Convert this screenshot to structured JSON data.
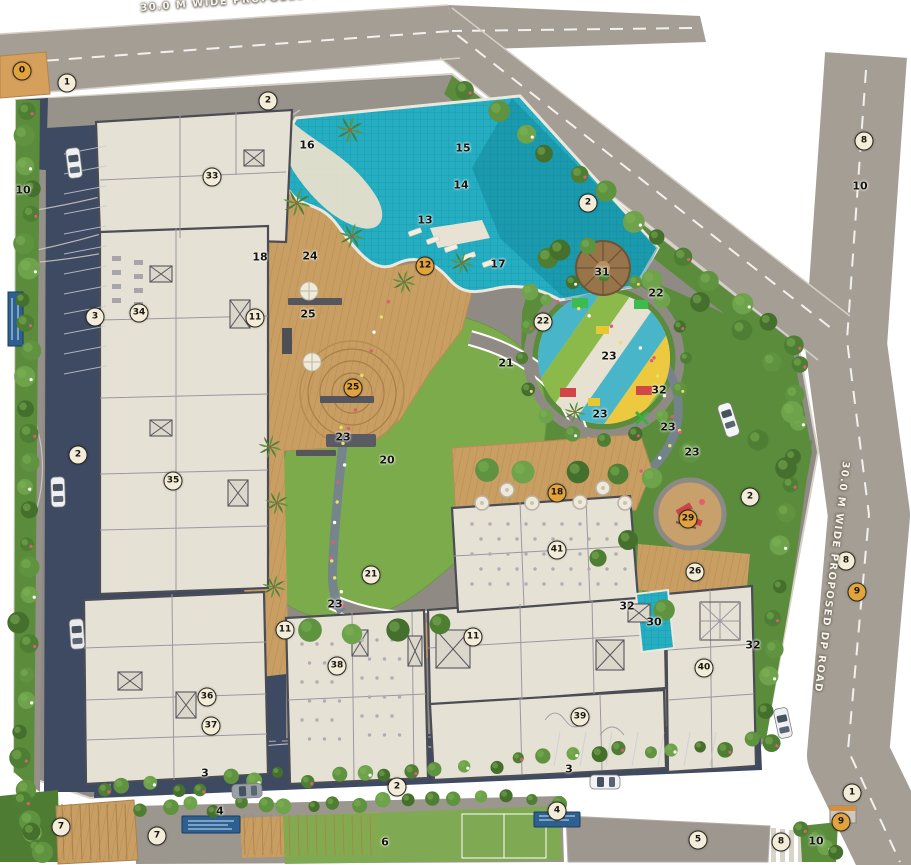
{
  "roads": {
    "top_label": "30.0 M WIDE PROPOSED DP ROAD",
    "right_label": "30.0 M WIDE PROPOSED DP ROAD"
  },
  "colors": {
    "outer_road": "#a59e94",
    "inner_paving": "#8f8b84",
    "asphalt": "#3e4962",
    "green_buffer": "#5a8c3c",
    "lawn": "#7cab4c",
    "wood_deck": "#c89e63",
    "deck_line": "#b68c52",
    "pool_water": "#25aec2",
    "building_fill": "#e6e1d5",
    "building_wall": "#4c4c55",
    "marker_light": "#f3ecd9",
    "marker_orange": "#e2a23c",
    "play_sand": "#dcc9a0"
  },
  "markers": [
    {
      "n": "0",
      "x": 22,
      "y": 71,
      "v": "orange"
    },
    {
      "n": "1",
      "x": 67,
      "y": 83,
      "v": "light"
    },
    {
      "n": "2",
      "x": 268,
      "y": 101,
      "v": "light"
    },
    {
      "n": "10",
      "x": 23,
      "y": 190,
      "v": "plain"
    },
    {
      "n": "33",
      "x": 212,
      "y": 177,
      "v": "light"
    },
    {
      "n": "16",
      "x": 307,
      "y": 145,
      "v": "plain"
    },
    {
      "n": "15",
      "x": 463,
      "y": 148,
      "v": "plain"
    },
    {
      "n": "14",
      "x": 461,
      "y": 185,
      "v": "plain"
    },
    {
      "n": "13",
      "x": 425,
      "y": 220,
      "v": "plain"
    },
    {
      "n": "12",
      "x": 425,
      "y": 266,
      "v": "orange"
    },
    {
      "n": "17",
      "x": 498,
      "y": 264,
      "v": "plain"
    },
    {
      "n": "2",
      "x": 588,
      "y": 203,
      "v": "light"
    },
    {
      "n": "8",
      "x": 864,
      "y": 141,
      "v": "light"
    },
    {
      "n": "10",
      "x": 860,
      "y": 186,
      "v": "plain"
    },
    {
      "n": "18",
      "x": 260,
      "y": 257,
      "v": "plain"
    },
    {
      "n": "24",
      "x": 310,
      "y": 256,
      "v": "plain"
    },
    {
      "n": "25",
      "x": 308,
      "y": 314,
      "v": "plain"
    },
    {
      "n": "11",
      "x": 255,
      "y": 318,
      "v": "light"
    },
    {
      "n": "34",
      "x": 139,
      "y": 313,
      "v": "light"
    },
    {
      "n": "3",
      "x": 95,
      "y": 317,
      "v": "light"
    },
    {
      "n": "31",
      "x": 602,
      "y": 272,
      "v": "plain"
    },
    {
      "n": "22",
      "x": 656,
      "y": 293,
      "v": "plain"
    },
    {
      "n": "22",
      "x": 543,
      "y": 322,
      "v": "light"
    },
    {
      "n": "23",
      "x": 609,
      "y": 356,
      "v": "plain"
    },
    {
      "n": "32",
      "x": 659,
      "y": 390,
      "v": "plain"
    },
    {
      "n": "23",
      "x": 600,
      "y": 414,
      "v": "plain"
    },
    {
      "n": "23",
      "x": 668,
      "y": 427,
      "v": "plain"
    },
    {
      "n": "21",
      "x": 506,
      "y": 363,
      "v": "plain"
    },
    {
      "n": "23",
      "x": 343,
      "y": 437,
      "v": "plain"
    },
    {
      "n": "25",
      "x": 353,
      "y": 388,
      "v": "orange"
    },
    {
      "n": "20",
      "x": 387,
      "y": 460,
      "v": "plain"
    },
    {
      "n": "2",
      "x": 78,
      "y": 455,
      "v": "light"
    },
    {
      "n": "35",
      "x": 173,
      "y": 481,
      "v": "light"
    },
    {
      "n": "18",
      "x": 557,
      "y": 493,
      "v": "orange"
    },
    {
      "n": "23",
      "x": 692,
      "y": 452,
      "v": "plain"
    },
    {
      "n": "29",
      "x": 688,
      "y": 519,
      "v": "orange"
    },
    {
      "n": "41",
      "x": 557,
      "y": 550,
      "v": "light"
    },
    {
      "n": "26",
      "x": 695,
      "y": 572,
      "v": "light"
    },
    {
      "n": "2",
      "x": 750,
      "y": 497,
      "v": "light"
    },
    {
      "n": "8",
      "x": 846,
      "y": 561,
      "v": "light"
    },
    {
      "n": "9",
      "x": 857,
      "y": 592,
      "v": "orange"
    },
    {
      "n": "32",
      "x": 627,
      "y": 606,
      "v": "plain"
    },
    {
      "n": "30",
      "x": 654,
      "y": 622,
      "v": "plain"
    },
    {
      "n": "32",
      "x": 753,
      "y": 645,
      "v": "plain"
    },
    {
      "n": "40",
      "x": 704,
      "y": 668,
      "v": "light"
    },
    {
      "n": "21",
      "x": 371,
      "y": 575,
      "v": "light"
    },
    {
      "n": "23",
      "x": 335,
      "y": 604,
      "v": "plain"
    },
    {
      "n": "11",
      "x": 285,
      "y": 630,
      "v": "light"
    },
    {
      "n": "11",
      "x": 473,
      "y": 637,
      "v": "light"
    },
    {
      "n": "38",
      "x": 337,
      "y": 666,
      "v": "light"
    },
    {
      "n": "36",
      "x": 207,
      "y": 697,
      "v": "light"
    },
    {
      "n": "37",
      "x": 211,
      "y": 726,
      "v": "light"
    },
    {
      "n": "39",
      "x": 580,
      "y": 717,
      "v": "light"
    },
    {
      "n": "3",
      "x": 205,
      "y": 773,
      "v": "plain"
    },
    {
      "n": "3",
      "x": 569,
      "y": 769,
      "v": "plain"
    },
    {
      "n": "2",
      "x": 397,
      "y": 787,
      "v": "light"
    },
    {
      "n": "4",
      "x": 220,
      "y": 811,
      "v": "plain"
    },
    {
      "n": "4",
      "x": 557,
      "y": 811,
      "v": "light"
    },
    {
      "n": "7",
      "x": 61,
      "y": 827,
      "v": "light"
    },
    {
      "n": "7",
      "x": 157,
      "y": 836,
      "v": "light"
    },
    {
      "n": "6",
      "x": 385,
      "y": 842,
      "v": "plain"
    },
    {
      "n": "5",
      "x": 698,
      "y": 840,
      "v": "light"
    },
    {
      "n": "8",
      "x": 781,
      "y": 842,
      "v": "light"
    },
    {
      "n": "10",
      "x": 816,
      "y": 841,
      "v": "plain"
    },
    {
      "n": "9",
      "x": 841,
      "y": 822,
      "v": "orange"
    },
    {
      "n": "1",
      "x": 852,
      "y": 793,
      "v": "light"
    }
  ]
}
